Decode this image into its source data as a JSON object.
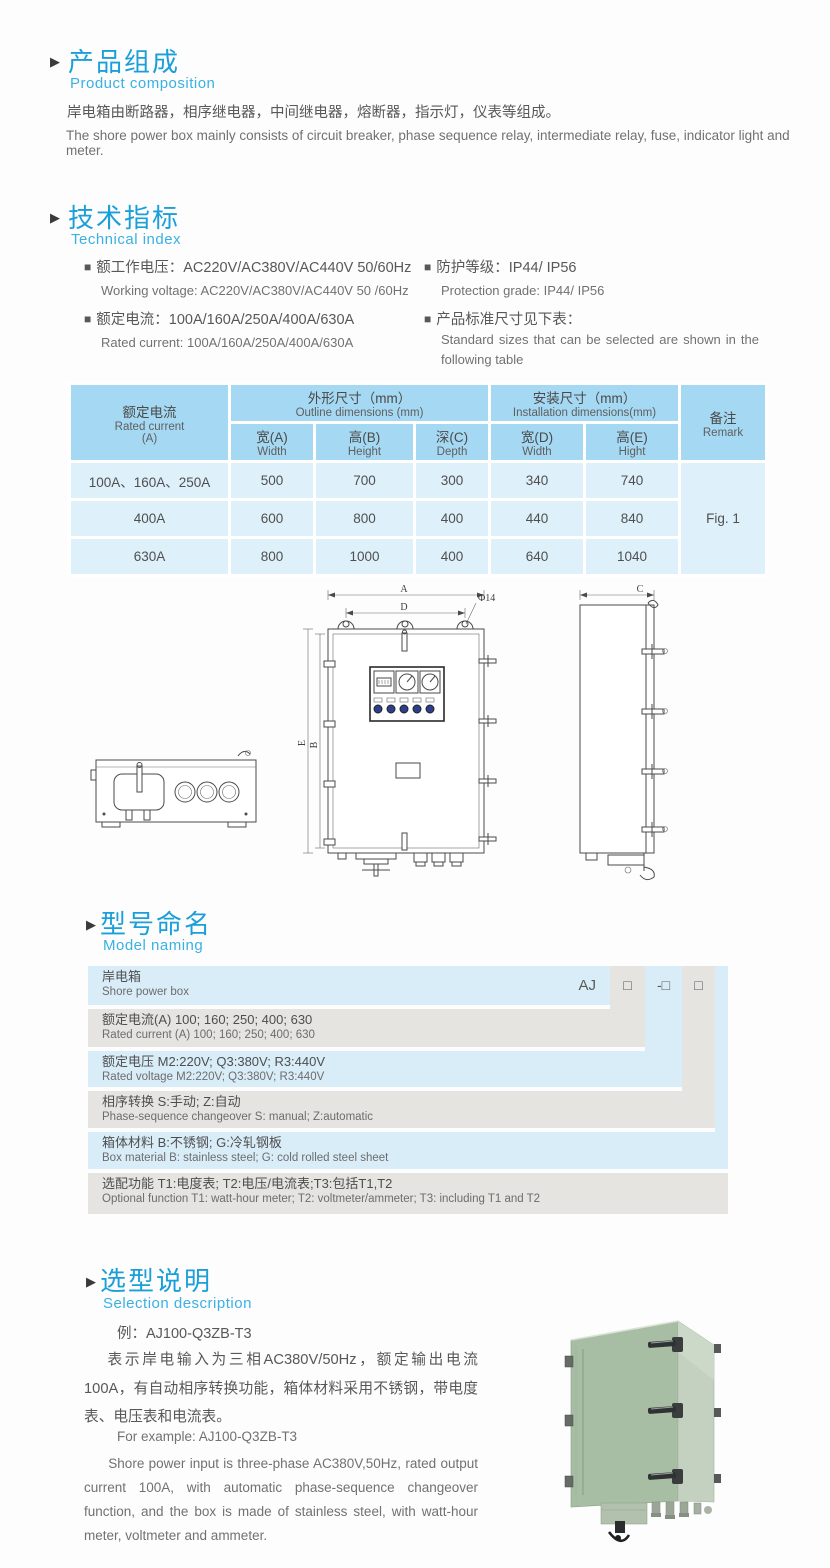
{
  "colors": {
    "accent_blue": "#1a9fd9",
    "subtitle_blue": "#3ab0e4",
    "table_header_bg": "#a5d8f2",
    "table_body_bg": "#def0fa",
    "naming_blue": "#d9edf9",
    "naming_gray": "#e5e4e1",
    "body_text": "#595757",
    "box_green": "#a8bea4"
  },
  "composition": {
    "arrow": "▶",
    "title_cn": "产品组成",
    "title_en": "Product composition",
    "body_cn": "岸电箱由断路器，相序继电器，中间继电器，熔断器，指示灯，仪表等组成。",
    "body_en": "The shore power box mainly consists of circuit breaker, phase sequence relay, intermediate relay, fuse, indicator light and meter."
  },
  "technical": {
    "arrow": "▶",
    "title_cn": "技术指标",
    "title_en": "Technical index",
    "bullet": "■",
    "left": [
      {
        "cn": "额工作电压：AC220V/AC380V/AC440V 50/60Hz",
        "en": "Working voltage: AC220V/AC380V/AC440V 50 /60Hz"
      },
      {
        "cn": "额定电流：100A/160A/250A/400A/630A",
        "en": "Rated current: 100A/160A/250A/400A/630A"
      }
    ],
    "right": [
      {
        "cn": "防护等级：IP44/ IP56",
        "en": "Protection grade: IP44/ IP56"
      },
      {
        "cn": "产品标准尺寸见下表：",
        "en": "Standard sizes that can be selected are shown in the following table"
      }
    ]
  },
  "dim_table": {
    "col_current_cn": "额定电流",
    "col_current_en": "Rated current",
    "col_current_unit": "(A)",
    "group_outline_cn": "外形尺寸（mm）",
    "group_outline_en": "Outline dimensions (mm)",
    "group_install_cn": "安装尺寸（mm）",
    "group_install_en": "Installation dimensions(mm)",
    "sub": [
      {
        "cn": "宽(A)",
        "en": "Width"
      },
      {
        "cn": "高(B)",
        "en": "Height"
      },
      {
        "cn": "深(C)",
        "en": "Depth"
      },
      {
        "cn": "宽(D)",
        "en": "Width"
      },
      {
        "cn": "高(E)",
        "en": "Hight"
      }
    ],
    "col_remark_cn": "备注",
    "col_remark_en": "Remark",
    "rows": [
      {
        "label": "100A、160A、250A",
        "values": [
          "500",
          "700",
          "300",
          "340",
          "740"
        ]
      },
      {
        "label": "400A",
        "values": [
          "600",
          "800",
          "400",
          "440",
          "840"
        ]
      },
      {
        "label": "630A",
        "values": [
          "800",
          "1000",
          "400",
          "640",
          "1040"
        ]
      }
    ],
    "remark_value": "Fig. 1"
  },
  "drawing": {
    "label_a": "A",
    "label_b": "B",
    "label_c": "C",
    "label_d": "D",
    "label_e": "E",
    "label_phi": "Φ14"
  },
  "naming": {
    "arrow": "▶",
    "title_cn": "型号命名",
    "title_en": "Model naming",
    "prefix": "AJ",
    "ph1": "□",
    "ph2": "-□",
    "ph3": "□",
    "rows": [
      {
        "cn": "岸电箱",
        "en": "Shore power box"
      },
      {
        "cn": "额定电流(A)  100; 160; 250; 400; 630",
        "en": "Rated current (A) 100; 160; 250; 400; 630"
      },
      {
        "cn": "额定电压  M2:220V;  Q3:380V;  R3:440V",
        "en": "Rated voltage  M2:220V;  Q3:380V;  R3:440V"
      },
      {
        "cn": "相序转换  S:手动; Z:自动",
        "en": "Phase-sequence changeover  S: manual;  Z:automatic"
      },
      {
        "cn": "箱体材料  B:不锈钢;  G:冷轧钢板",
        "en": "Box material  B: stainless steel; G: cold rolled steel sheet"
      },
      {
        "cn": "选配功能  T1:电度表;  T2:电压/电流表;T3:包括T1,T2",
        "en": "Optional function  T1: watt-hour meter; T2: voltmeter/ammeter; T3: including T1 and T2"
      }
    ]
  },
  "selection": {
    "arrow": "▶",
    "title_cn": "选型说明",
    "title_en": "Selection description",
    "example_cn": "例：AJ100-Q3ZB-T3",
    "body_cn": "表示岸电输入为三相AC380V/50Hz，额定输出电流100A，有自动相序转换功能，箱体材料采用不锈钢，带电度表、电压表和电流表。",
    "example_en": "For example: AJ100-Q3ZB-T3",
    "body_en": "Shore power input is three-phase AC380V,50Hz, rated output current 100A, with automatic phase-sequence changeover function, and the box is made of stainless steel, with watt-hour meter, voltmeter and ammeter."
  }
}
